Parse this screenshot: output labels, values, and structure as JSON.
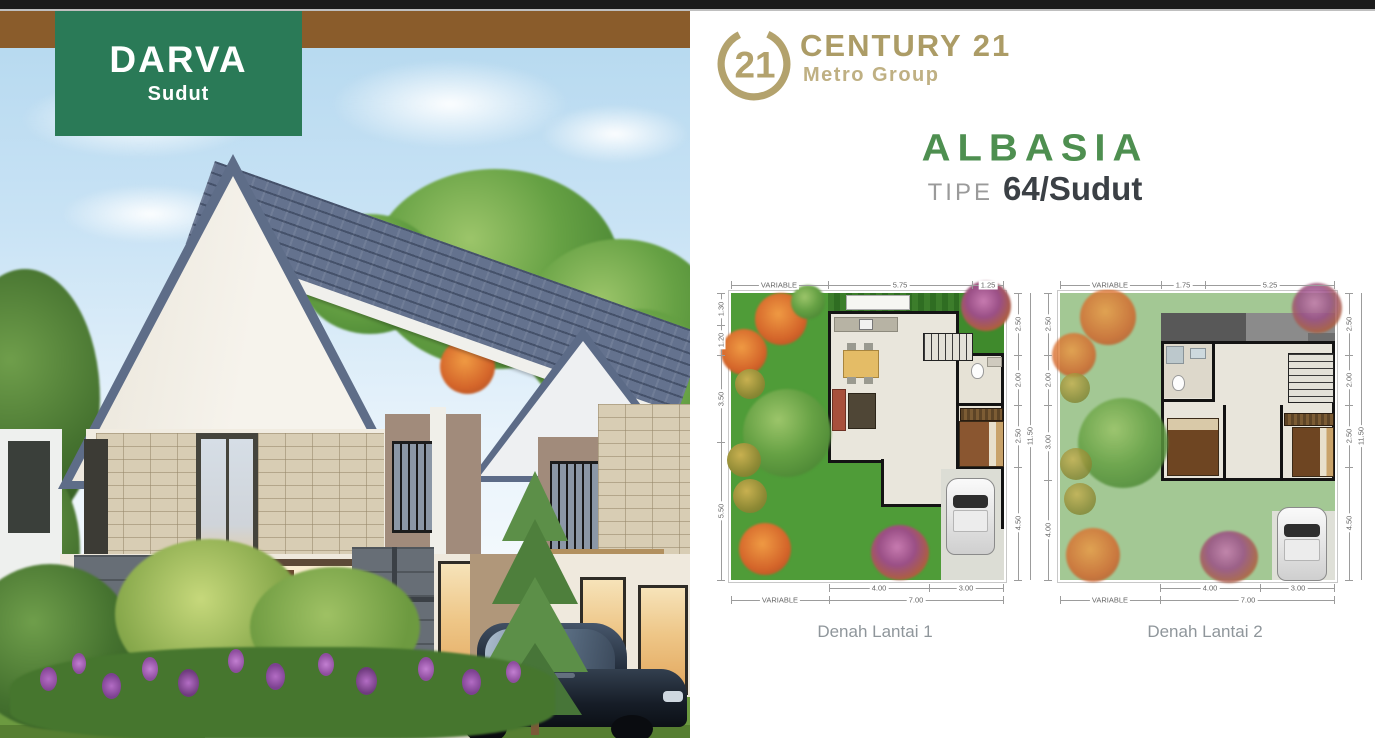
{
  "page": {
    "top_bar_color": "#1b1b1b",
    "background": "#ffffff"
  },
  "hero": {
    "banner_color": "#8a5c2b",
    "badge": {
      "title": "DARVA",
      "subtitle": "Sudut",
      "bg_color": "#2a7a57"
    }
  },
  "brand": {
    "logo_number": "21",
    "name": "CENTURY 21",
    "subname": "Metro Group",
    "gold_color": "#b1a06b"
  },
  "product": {
    "name": "ALBASIA",
    "type_label": "TIPE",
    "type_value": "64/Sudut",
    "green_color": "#4e8f50"
  },
  "plans": [
    {
      "caption": "Denah Lantai 1",
      "dims_top": [
        "VARIABLE",
        "5.75",
        "1.25"
      ],
      "dims_left": [
        "1.30",
        "1.20",
        "3.50",
        "5.50"
      ],
      "dims_right": [
        "2.50",
        "2.00",
        "2.50",
        "4.50"
      ],
      "dims_right_total": "11.50",
      "dims_bottom_inner": [
        "4.00",
        "3.00"
      ],
      "dims_bottom_outer": [
        "VARIABLE",
        "7.00"
      ]
    },
    {
      "caption": "Denah Lantai 2",
      "dims_top": [
        "VARIABLE",
        "1.75",
        "5.25"
      ],
      "dims_left": [
        "2.50",
        "2.00",
        "3.00",
        "4.00"
      ],
      "dims_right": [
        "2.50",
        "2.00",
        "2.50",
        "4.50"
      ],
      "dims_right_total": "11.50",
      "dims_bottom_inner": [
        "4.00",
        "3.00"
      ],
      "dims_bottom_outer": [
        "VARIABLE",
        "7.00"
      ]
    }
  ]
}
